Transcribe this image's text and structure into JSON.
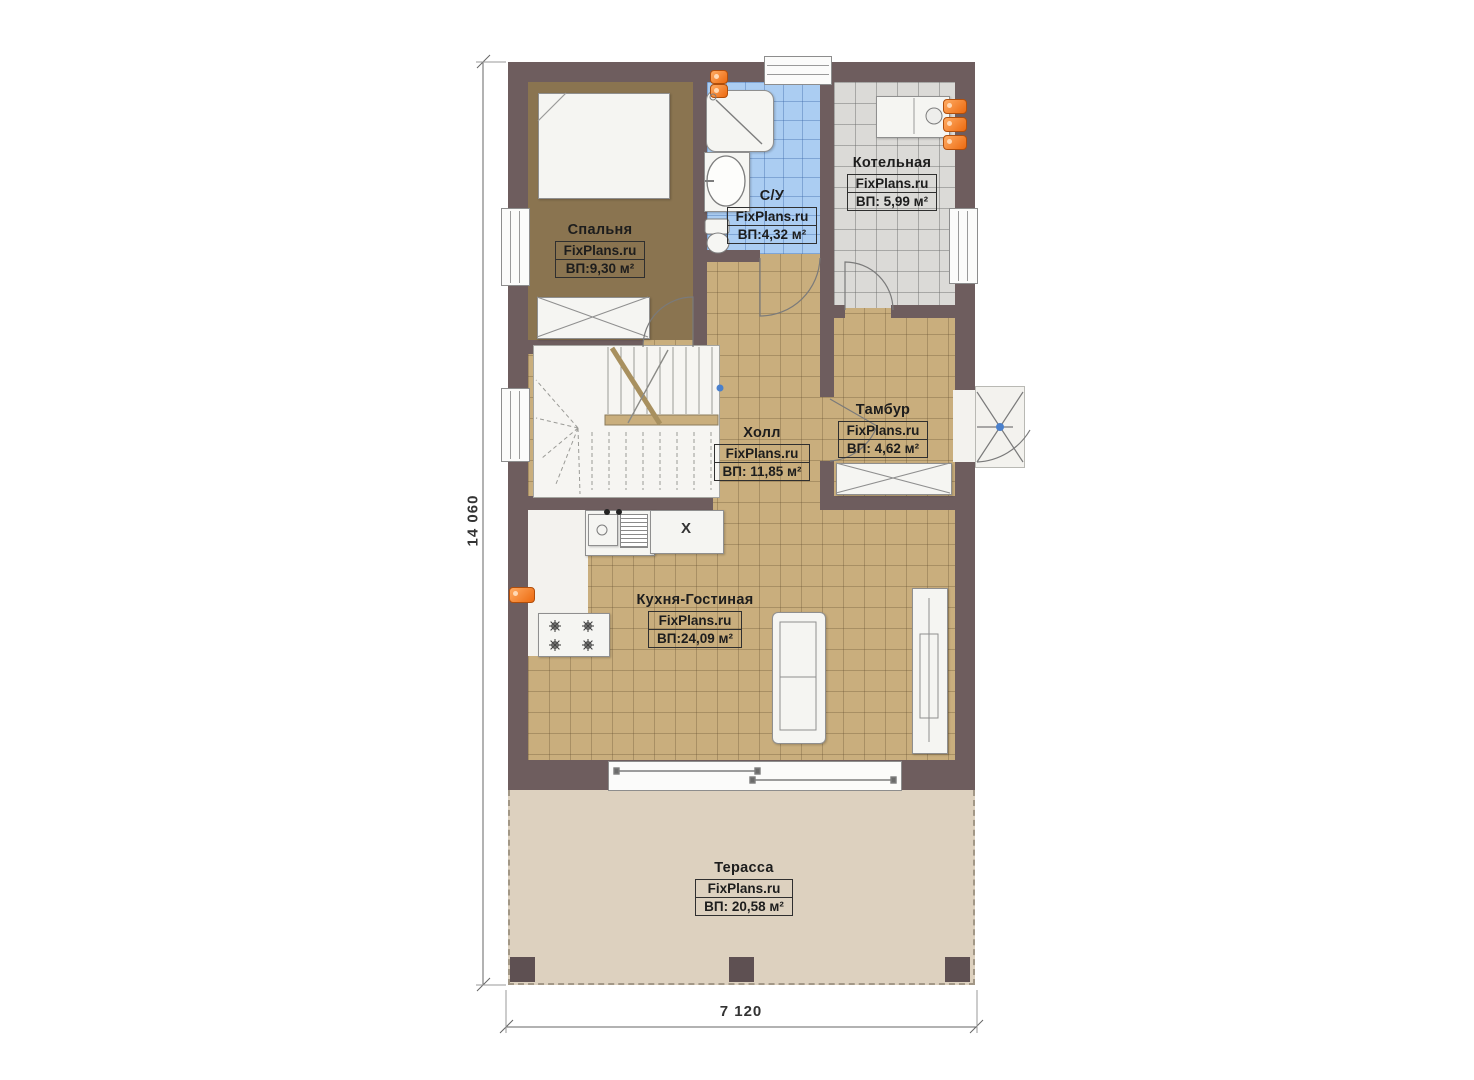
{
  "plan": {
    "title": "floor-plan-first-floor",
    "rooms": [
      {
        "key": "bedroom",
        "name": "Спальня",
        "brand": "FixPlans.ru",
        "area": "ВП:9,30 м²"
      },
      {
        "key": "bathroom",
        "name": "С/У",
        "brand": "FixPlans.ru",
        "area": "ВП:4,32 м²"
      },
      {
        "key": "boiler",
        "name": "Котельная",
        "brand": "FixPlans.ru",
        "area": "ВП: 5,99 м²"
      },
      {
        "key": "hall",
        "name": "Холл",
        "brand": "FixPlans.ru",
        "area": "ВП: 11,85 м²"
      },
      {
        "key": "vestibule",
        "name": "Тамбур",
        "brand": "FixPlans.ru",
        "area": "ВП: 4,62 м²"
      },
      {
        "key": "kitchen_living",
        "name": "Кухня-Гостиная",
        "brand": "FixPlans.ru",
        "area": "ВП:24,09 м²"
      },
      {
        "key": "terrace",
        "name": "Терасса",
        "brand": "FixPlans.ru",
        "area": "ВП: 20,58 м²"
      }
    ],
    "dimensions": {
      "vertical": "14 060",
      "horizontal": "7 120"
    },
    "annotations": {
      "kitchen_unit_letter": "X"
    },
    "colors": {
      "wall": "#6e5d5e",
      "tile_tan": "#c9ae7d",
      "tile_blue": "#abcdf2",
      "tile_gray": "#dbdad7",
      "bedroom_floor": "#8a7450",
      "terrace": "#ddd1bf",
      "radiator_orange": "#ec6a10"
    }
  }
}
